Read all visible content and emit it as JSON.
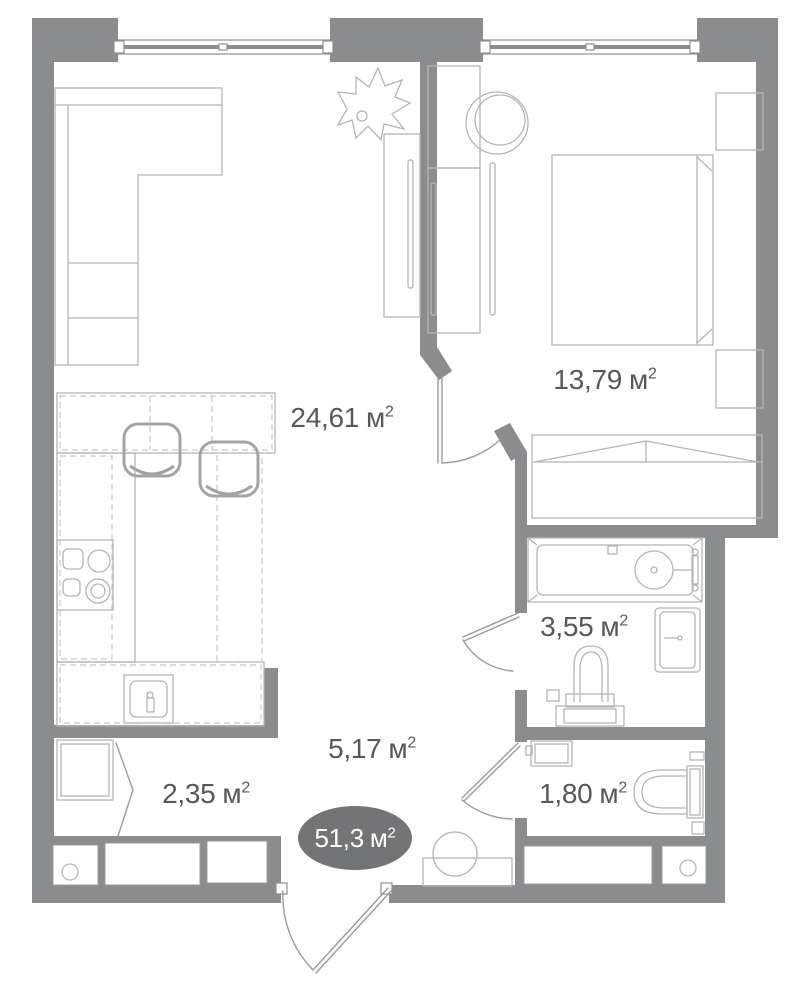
{
  "plan": {
    "total_area": {
      "value": "51,3",
      "unit": "м",
      "sup": "2"
    },
    "rooms": [
      {
        "id": "living-kitchen",
        "value": "24,61",
        "unit": "м",
        "sup": "2"
      },
      {
        "id": "bedroom",
        "value": "13,79",
        "unit": "м",
        "sup": "2"
      },
      {
        "id": "bathroom",
        "value": "3,55",
        "unit": "м",
        "sup": "2"
      },
      {
        "id": "hallway",
        "value": "5,17",
        "unit": "м",
        "sup": "2"
      },
      {
        "id": "storage",
        "value": "2,35",
        "unit": "м",
        "sup": "2"
      },
      {
        "id": "wc",
        "value": "1,80",
        "unit": "м",
        "sup": "2"
      }
    ],
    "icons": [
      "window-icon",
      "entrance-door-icon",
      "bedroom-door-icon",
      "bathroom-door-icon",
      "wc-door-icon",
      "sofa-icon",
      "plant-icon",
      "tv-icon",
      "tv-console-icon",
      "wardrobe-icon",
      "armchair-icon",
      "bed-icon",
      "nightstand-icon",
      "closet-icon",
      "bathtub-icon",
      "water-heater-cabinet-icon",
      "toilet-icon",
      "vanity-sink-icon",
      "wc-sink-icon",
      "wc-toilet-icon",
      "kitchen-counter-icon",
      "bar-stool-icon",
      "cooktop-icon",
      "kitchen-sink-icon",
      "hall-console-icon",
      "pouf-icon",
      "service-shaft-icon"
    ],
    "colors": {
      "wall": "#8b8c8e",
      "furniture_line": "#b4b5b7",
      "furniture_dark": "#a3a4a6",
      "text": "#57585a",
      "badge_fill": "#737476",
      "badge_text": "#ffffff",
      "background": "#ffffff",
      "window_frame": "#8f9092",
      "door_line": "#9a9b9d"
    }
  }
}
